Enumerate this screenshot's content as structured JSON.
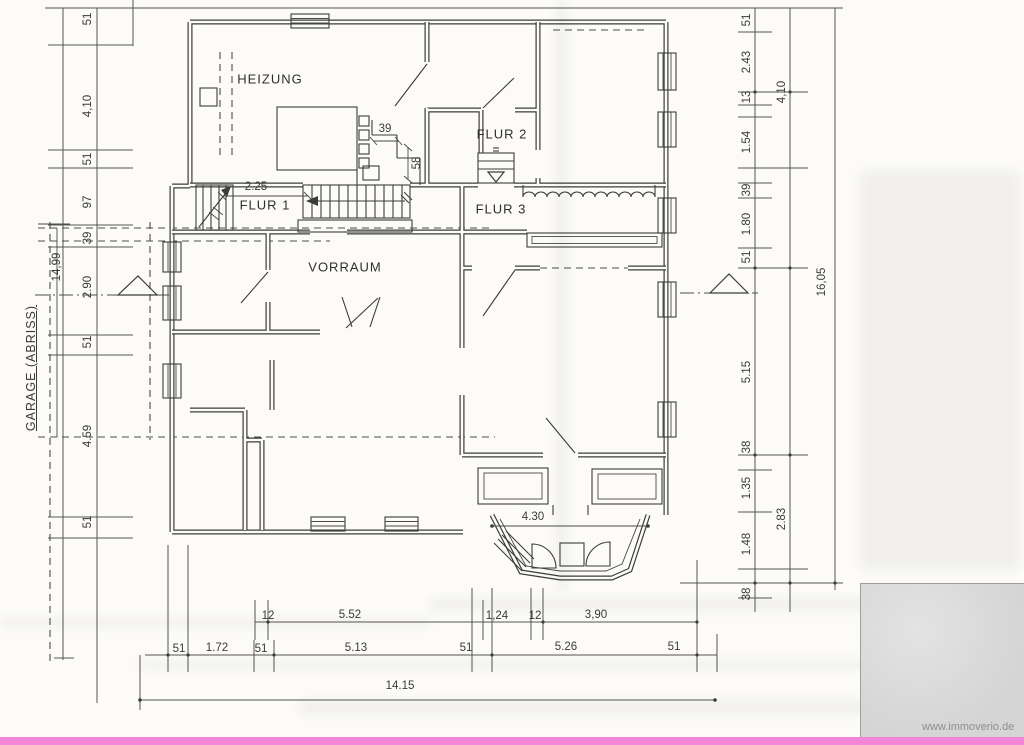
{
  "plan": {
    "rooms": {
      "heizung": "HEIZUNG",
      "flur1": "FLUR 1",
      "flur2": "FLUR 2",
      "flur3": "FLUR 3",
      "vorraum": "VORRAUM"
    },
    "garage_label": "GARAGE (ABRISS)",
    "garage_length": "14,99"
  },
  "dims": {
    "left": [
      "51",
      "4,10",
      "51",
      "97",
      "39",
      "2.90",
      "51",
      "4.59",
      "51"
    ],
    "right1": [
      "51",
      "2.43",
      "13",
      "1.54",
      "39",
      "1.80",
      "51",
      "5.15",
      "38",
      "1.35",
      "1.48",
      "38"
    ],
    "right2": [
      "4,10",
      "2.83"
    ],
    "right3": [
      "16,05"
    ],
    "row1": [
      "12",
      "5.52",
      "1,24",
      "12",
      "3,90"
    ],
    "row2": [
      "51",
      "1.72",
      "51",
      "5.13",
      "51",
      "5.26",
      "51"
    ],
    "total": "14.15",
    "inner": [
      "2.25",
      "39",
      "58",
      "4.30"
    ]
  },
  "watermark": "www.immoverio.de",
  "colors": {
    "highlight_bar": "#f287d7",
    "ink": "#3c3c3c",
    "paper": "#fcfbf8"
  }
}
